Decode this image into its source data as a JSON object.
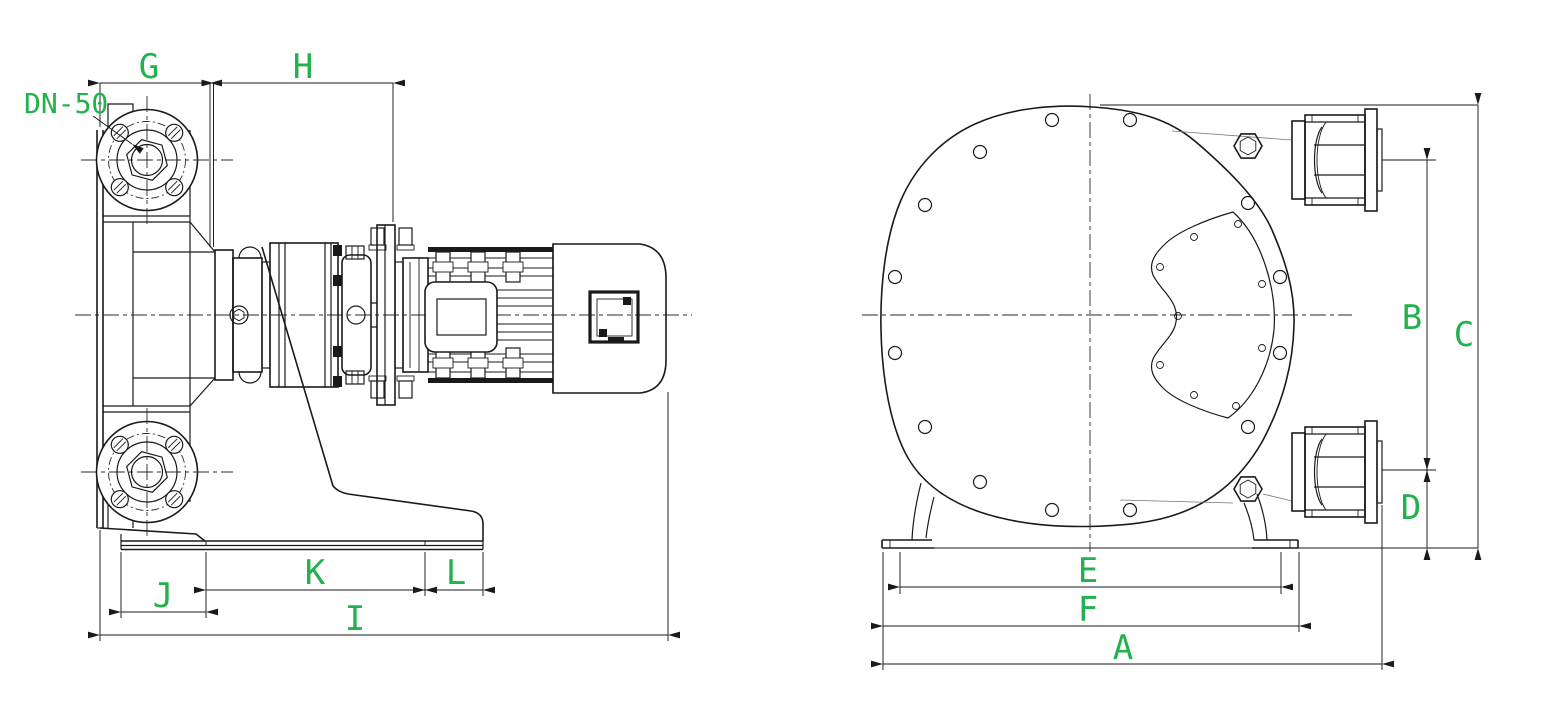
{
  "colors": {
    "label": "#22b14c",
    "line": "#1a1a1a"
  },
  "annotations": {
    "port_size": "DN-50"
  },
  "side_view": {
    "dim_labels": {
      "G": "G",
      "H": "H",
      "I": "I",
      "J": "J",
      "K": "K",
      "L": "L"
    }
  },
  "front_view": {
    "dim_labels": {
      "A": "A",
      "B": "B",
      "C": "C",
      "D": "D",
      "E": "E",
      "F": "F"
    }
  }
}
